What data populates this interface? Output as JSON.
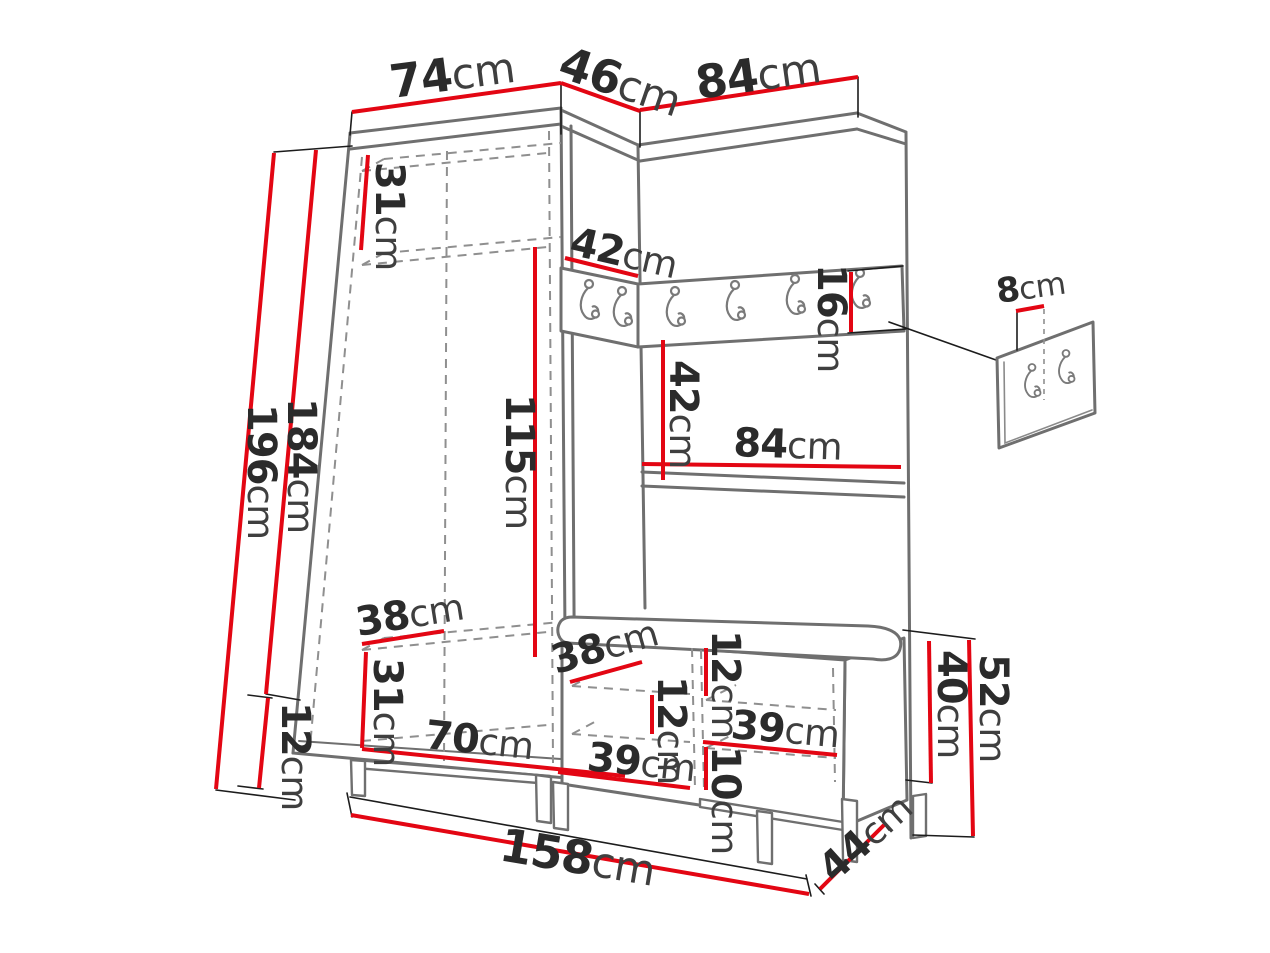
{
  "page": {
    "type": "furniture-dimension-diagram",
    "subject": "hallway wardrobe set with corner unit, coat-hook rail, bench and wall hook panel detail"
  },
  "colors": {
    "dimension_line": "#e30613",
    "structure_outline": "#6f6f6f",
    "label_text": "#2b2b2b",
    "background": "#ffffff"
  },
  "icons": {
    "coat_hook": "j-shaped coat hook with mounting dots"
  },
  "dimensions": {
    "wardrobe_top_width": {
      "value": "74",
      "unit": "cm"
    },
    "corner_top_width": {
      "value": "46",
      "unit": "cm"
    },
    "panel_top_width": {
      "value": "84",
      "unit": "cm"
    },
    "total_height": {
      "value": "196",
      "unit": "cm"
    },
    "cabinet_height": {
      "value": "184",
      "unit": "cm"
    },
    "top_shelf_height": {
      "value": "31",
      "unit": "cm"
    },
    "corner_shelf_width": {
      "value": "42",
      "unit": "cm"
    },
    "hook_rail_height": {
      "value": "16",
      "unit": "cm"
    },
    "hanging_space_height": {
      "value": "115",
      "unit": "cm"
    },
    "panel_gap_height": {
      "value": "42",
      "unit": "cm"
    },
    "panel_shelf_width": {
      "value": "84",
      "unit": "cm"
    },
    "hook_panel_offset": {
      "value": "8",
      "unit": "cm"
    },
    "wardrobe_shelf_depth": {
      "value": "38",
      "unit": "cm"
    },
    "bottom_shelf_height": {
      "value": "31",
      "unit": "cm"
    },
    "plinth_height": {
      "value": "12",
      "unit": "cm"
    },
    "wardrobe_inner_width": {
      "value": "70",
      "unit": "cm"
    },
    "bench_shelf_depth": {
      "value": "38",
      "unit": "cm"
    },
    "bench_top_clearance": {
      "value": "12",
      "unit": "cm"
    },
    "bench_left_clearance": {
      "value": "12",
      "unit": "cm"
    },
    "bench_upper_width": {
      "value": "39",
      "unit": "cm"
    },
    "bench_lower_clearance": {
      "value": "10",
      "unit": "cm"
    },
    "bench_lower_width": {
      "value": "39",
      "unit": "cm"
    },
    "bench_body_height": {
      "value": "40",
      "unit": "cm"
    },
    "bench_total_height": {
      "value": "52",
      "unit": "cm"
    },
    "bench_depth": {
      "value": "44",
      "unit": "cm"
    },
    "total_width": {
      "value": "158",
      "unit": "cm"
    }
  }
}
